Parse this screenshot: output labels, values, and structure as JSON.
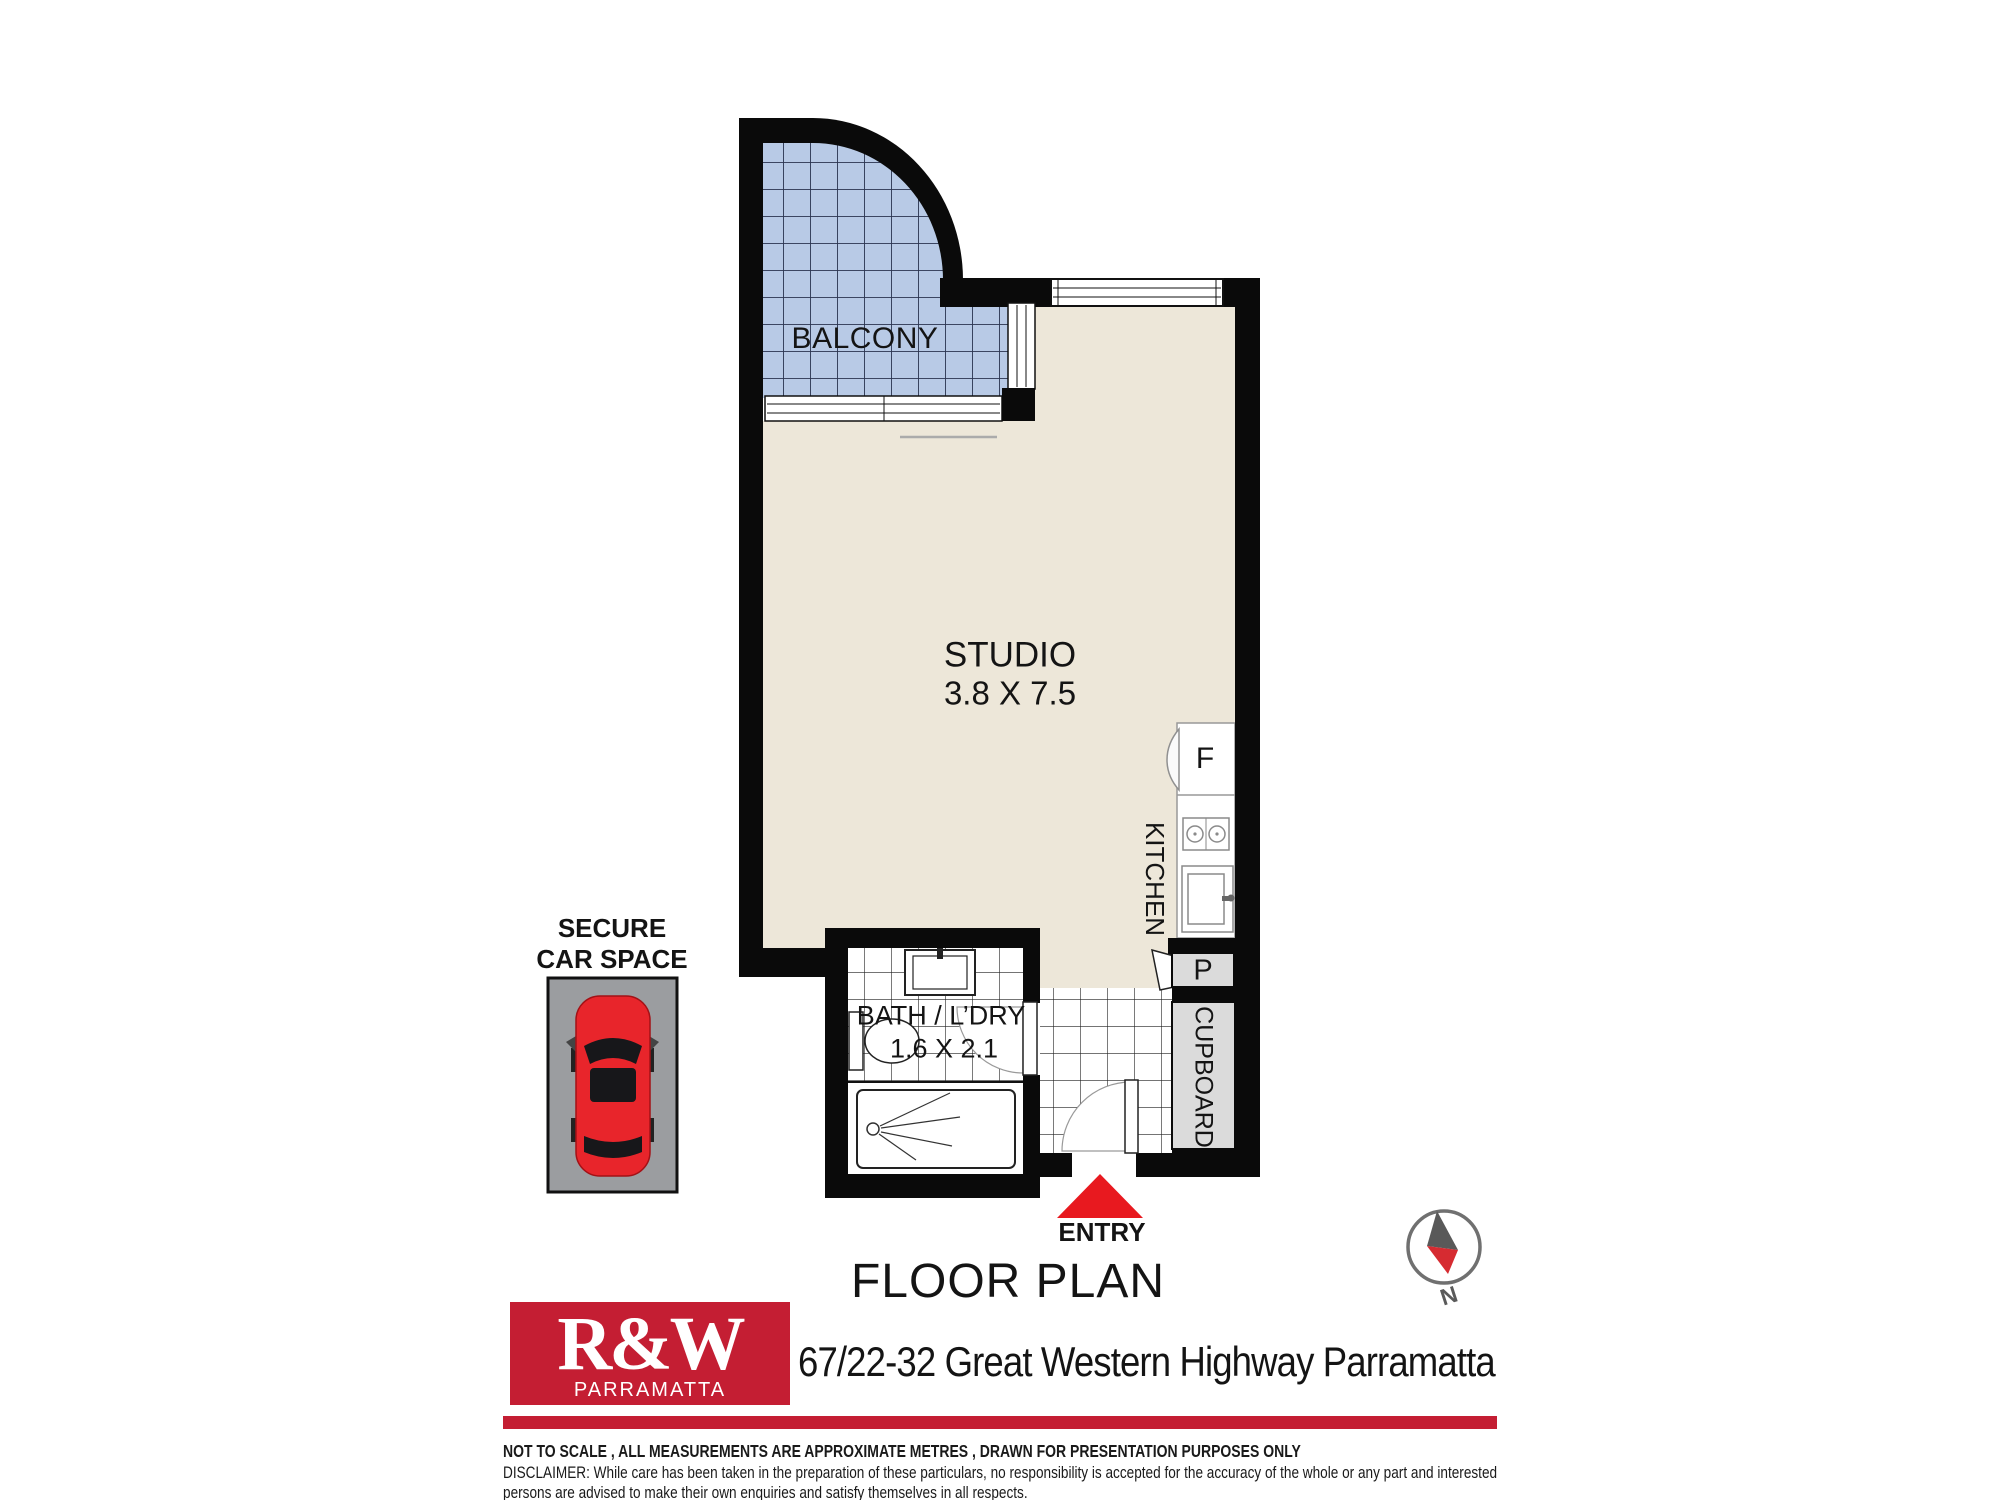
{
  "floor_plan": {
    "rooms": {
      "balcony": {
        "label": "BALCONY"
      },
      "studio": {
        "label": "STUDIO",
        "dimensions": "3.8 X 7.5"
      },
      "kitchen": {
        "label": "KITCHEN",
        "fridge_label": "F",
        "pantry_label": "P"
      },
      "bath_laundry": {
        "label": "BATH / L’DRY",
        "dimensions": "1.6 X 2.1"
      },
      "cupboard": {
        "label": "CUPBOARD"
      }
    },
    "entry": {
      "label": "ENTRY"
    },
    "car_space": {
      "label_line1": "SECURE",
      "label_line2": "CAR SPACE"
    },
    "compass": {
      "label": "N"
    }
  },
  "title": "FLOOR PLAN",
  "agency": {
    "logo_text": "R&W",
    "logo_subtext": "PARRAMATTA"
  },
  "address": "67/22-32 Great Western Highway Parramatta",
  "disclaimer": {
    "line1": "NOT TO SCALE , ALL MEASUREMENTS ARE APPROXIMATE METRES , DRAWN FOR PRESENTATION PURPOSES ONLY",
    "line2": "DISCLAIMER:  While care has been taken in the preparation of these particulars, no responsibility is accepted for the accuracy of the whole or any part and interested",
    "line3": "persons are advised to make their own enquiries and satisfy  themselves in all respects."
  },
  "colors": {
    "wall": "#0a0a0a",
    "floor_beige": "#EDE7D9",
    "balcony_tile": "#B8CAE6",
    "balcony_grid_line": "#2A3450",
    "tile_grid_line": "#222222",
    "cabinet_gray": "#DBDBDB",
    "carspace_gray": "#9B9DA0",
    "car_red": "#E8252B",
    "entry_marker_red": "#E8191F",
    "brand_red": "#C41E33"
  }
}
